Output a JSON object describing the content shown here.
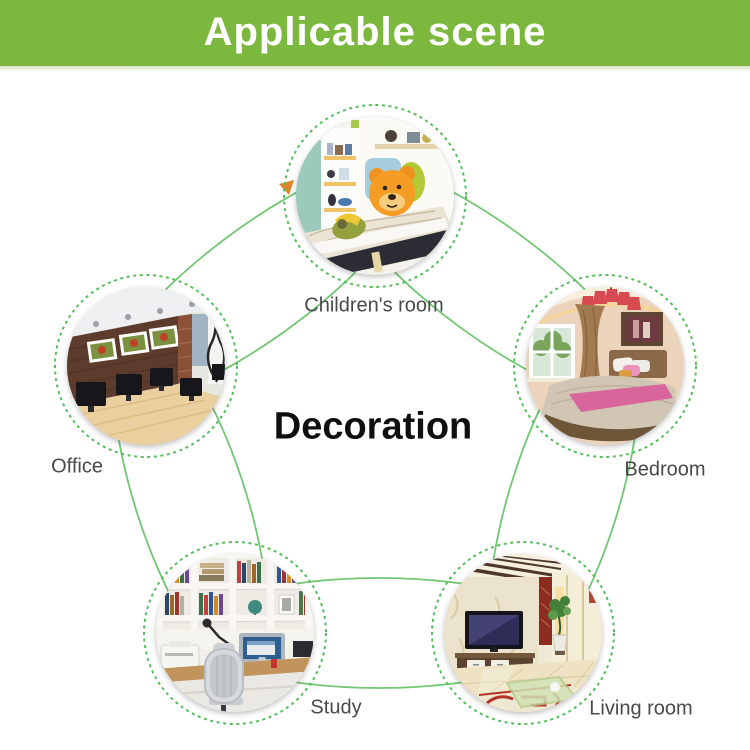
{
  "header": {
    "title": "Applicable scene"
  },
  "center_title": "Decoration",
  "scenes": [
    {
      "id": "children-room",
      "label": "Children's room"
    },
    {
      "id": "office",
      "label": "Office"
    },
    {
      "id": "bedroom",
      "label": "Bedroom"
    },
    {
      "id": "study",
      "label": "Study"
    },
    {
      "id": "living-room",
      "label": "Living room"
    }
  ],
  "colors": {
    "header_green": "#7cb83e",
    "connector_green": "#72c674",
    "dashed_ring_green": "#54bf5a",
    "arrow_orange": "#e0832e",
    "label_gray": "#494949"
  }
}
